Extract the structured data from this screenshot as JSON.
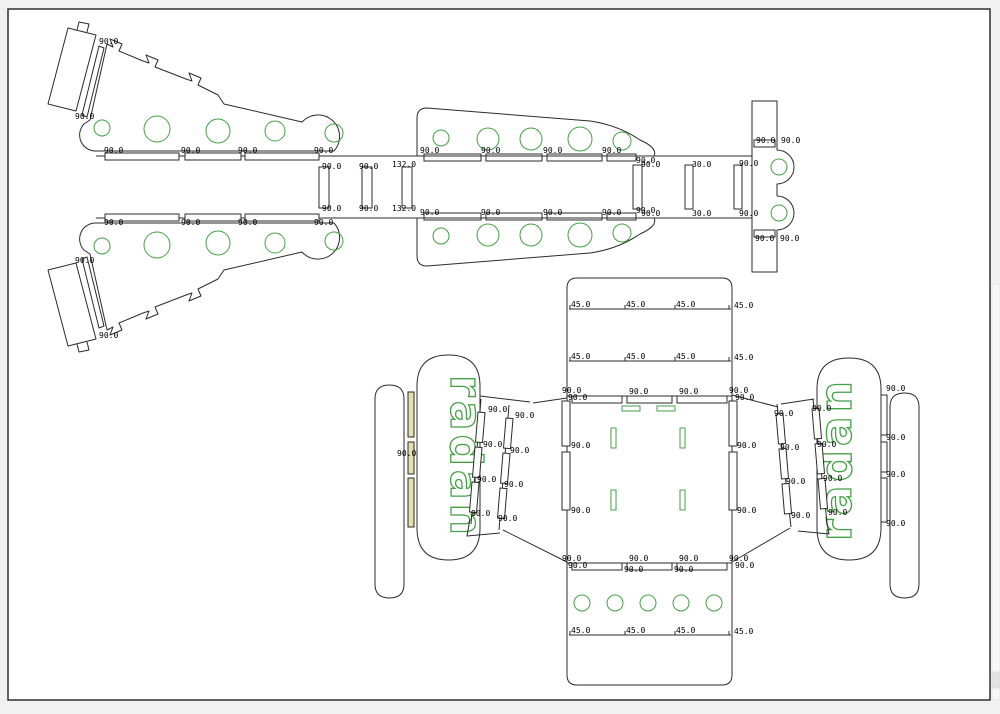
{
  "app": {
    "name": "cad-nesting-view"
  },
  "colors": {
    "app_bg": "#f1f1f1",
    "border": "#2f2f2f",
    "cut": "#2b2b2b",
    "engrave": "#44a044",
    "fill_tan": "#e6deab",
    "dim_text": "#000000"
  },
  "engraving": {
    "left_wing_text": "radan",
    "right_wing_text": "radan"
  },
  "dimensions": [
    {
      "t": "90.0",
      "x": 99,
      "y": 44
    },
    {
      "t": "90.0",
      "x": 75,
      "y": 119
    },
    {
      "t": "90.0",
      "x": 104,
      "y": 153
    },
    {
      "t": "90.0",
      "x": 181,
      "y": 153
    },
    {
      "t": "90.0",
      "x": 238,
      "y": 153
    },
    {
      "t": "90.0",
      "x": 314,
      "y": 153
    },
    {
      "t": "90.0",
      "x": 104,
      "y": 225
    },
    {
      "t": "90.0",
      "x": 181,
      "y": 225
    },
    {
      "t": "90.0",
      "x": 238,
      "y": 225
    },
    {
      "t": "90.0",
      "x": 314,
      "y": 225
    },
    {
      "t": "90.0",
      "x": 322,
      "y": 169
    },
    {
      "t": "90.0",
      "x": 322,
      "y": 211
    },
    {
      "t": "90.0",
      "x": 75,
      "y": 263
    },
    {
      "t": "90.0",
      "x": 99,
      "y": 338
    },
    {
      "t": "90.0",
      "x": 359,
      "y": 169
    },
    {
      "t": "90.0",
      "x": 359,
      "y": 211
    },
    {
      "t": "132.0",
      "x": 392,
      "y": 167
    },
    {
      "t": "132.0",
      "x": 392,
      "y": 211
    },
    {
      "t": "90.0",
      "x": 420,
      "y": 153
    },
    {
      "t": "90.0",
      "x": 481,
      "y": 153
    },
    {
      "t": "90.0",
      "x": 543,
      "y": 153
    },
    {
      "t": "90.0",
      "x": 602,
      "y": 153
    },
    {
      "t": "90.0",
      "x": 636,
      "y": 163
    },
    {
      "t": "90.0",
      "x": 420,
      "y": 215
    },
    {
      "t": "90.0",
      "x": 481,
      "y": 215
    },
    {
      "t": "90.0",
      "x": 543,
      "y": 215
    },
    {
      "t": "90.0",
      "x": 602,
      "y": 215
    },
    {
      "t": "90.0",
      "x": 636,
      "y": 213
    },
    {
      "t": "90.0",
      "x": 641,
      "y": 167
    },
    {
      "t": "30.0",
      "x": 692,
      "y": 167
    },
    {
      "t": "90.0",
      "x": 739,
      "y": 166
    },
    {
      "t": "90.0",
      "x": 641,
      "y": 216
    },
    {
      "t": "30.0",
      "x": 692,
      "y": 216
    },
    {
      "t": "90.0",
      "x": 739,
      "y": 216
    },
    {
      "t": "90.0",
      "x": 756,
      "y": 143
    },
    {
      "t": "90.0",
      "x": 781,
      "y": 143
    },
    {
      "t": "90.0",
      "x": 755,
      "y": 241
    },
    {
      "t": "90.0",
      "x": 780,
      "y": 241
    },
    {
      "t": "45.0",
      "x": 571,
      "y": 307
    },
    {
      "t": "45.0",
      "x": 626,
      "y": 307
    },
    {
      "t": "45.0",
      "x": 676,
      "y": 307
    },
    {
      "t": "45.0",
      "x": 734,
      "y": 308
    },
    {
      "t": "45.0",
      "x": 571,
      "y": 359
    },
    {
      "t": "45.0",
      "x": 626,
      "y": 359
    },
    {
      "t": "45.0",
      "x": 676,
      "y": 359
    },
    {
      "t": "45.0",
      "x": 734,
      "y": 360
    },
    {
      "t": "90.0",
      "x": 562,
      "y": 393
    },
    {
      "t": "90.0",
      "x": 568,
      "y": 400
    },
    {
      "t": "90.0",
      "x": 629,
      "y": 394
    },
    {
      "t": "90.0",
      "x": 679,
      "y": 394
    },
    {
      "t": "90.0",
      "x": 729,
      "y": 393
    },
    {
      "t": "90.0",
      "x": 735,
      "y": 400
    },
    {
      "t": "90.0",
      "x": 571,
      "y": 448
    },
    {
      "t": "90.0",
      "x": 571,
      "y": 513
    },
    {
      "t": "90.0",
      "x": 737,
      "y": 448
    },
    {
      "t": "90.0",
      "x": 737,
      "y": 513
    },
    {
      "t": "90.0",
      "x": 562,
      "y": 561
    },
    {
      "t": "90.0",
      "x": 568,
      "y": 568
    },
    {
      "t": "90.0",
      "x": 629,
      "y": 561
    },
    {
      "t": "90.0",
      "x": 679,
      "y": 561
    },
    {
      "t": "90.0",
      "x": 729,
      "y": 561
    },
    {
      "t": "90.0",
      "x": 735,
      "y": 568
    },
    {
      "t": "90.0",
      "x": 624,
      "y": 572
    },
    {
      "t": "90.0",
      "x": 674,
      "y": 572
    },
    {
      "t": "45.0",
      "x": 571,
      "y": 633
    },
    {
      "t": "45.0",
      "x": 626,
      "y": 633
    },
    {
      "t": "45.0",
      "x": 676,
      "y": 633
    },
    {
      "t": "45.0",
      "x": 734,
      "y": 634
    },
    {
      "t": "90.0",
      "x": 397,
      "y": 456
    },
    {
      "t": "90.0",
      "x": 488,
      "y": 412
    },
    {
      "t": "90.0",
      "x": 483,
      "y": 447
    },
    {
      "t": "90.0",
      "x": 477,
      "y": 482
    },
    {
      "t": "90.0",
      "x": 471,
      "y": 516
    },
    {
      "t": "90.0",
      "x": 515,
      "y": 418
    },
    {
      "t": "90.0",
      "x": 510,
      "y": 453
    },
    {
      "t": "90.0",
      "x": 504,
      "y": 487
    },
    {
      "t": "90.0",
      "x": 498,
      "y": 521
    },
    {
      "t": "90.0",
      "x": 774,
      "y": 416
    },
    {
      "t": "90.0",
      "x": 780,
      "y": 450
    },
    {
      "t": "90.0",
      "x": 786,
      "y": 484
    },
    {
      "t": "90.0",
      "x": 791,
      "y": 518
    },
    {
      "t": "90.0",
      "x": 812,
      "y": 411
    },
    {
      "t": "90.0",
      "x": 817,
      "y": 447
    },
    {
      "t": "90.0",
      "x": 823,
      "y": 481
    },
    {
      "t": "90.0",
      "x": 828,
      "y": 515
    },
    {
      "t": "90.0",
      "x": 886,
      "y": 391
    },
    {
      "t": "90.0",
      "x": 886,
      "y": 440
    },
    {
      "t": "90.0",
      "x": 886,
      "y": 477
    },
    {
      "t": "90.0",
      "x": 886,
      "y": 526
    }
  ]
}
